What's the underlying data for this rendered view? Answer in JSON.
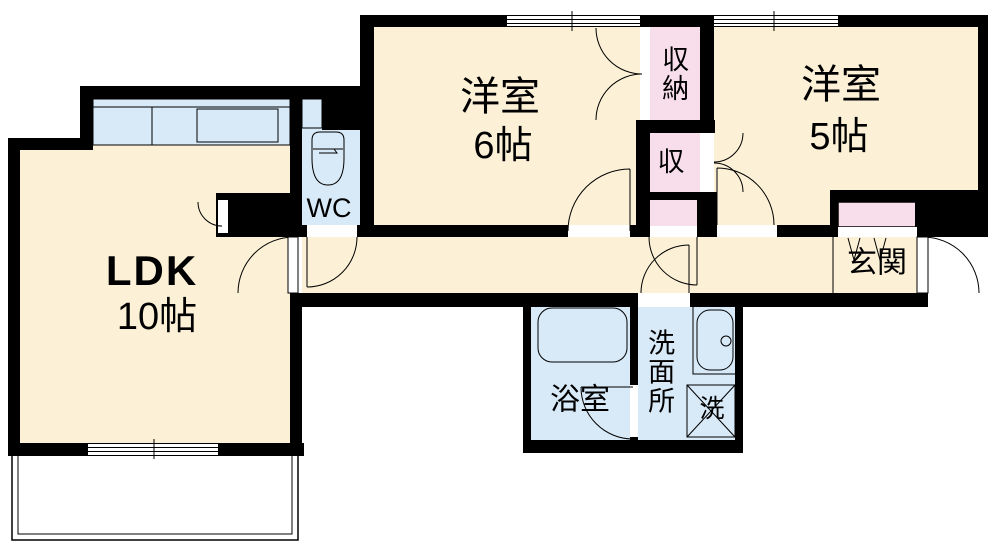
{
  "title": "2LDK apartment floor plan",
  "rooms": {
    "ldk": {
      "label": "LDK",
      "size": "10帖"
    },
    "western6": {
      "label": "洋室",
      "size": "6帖"
    },
    "western5": {
      "label": "洋室",
      "size": "5帖"
    },
    "storage": {
      "label": "収納"
    },
    "storage_small": {
      "label": "収"
    },
    "wc": {
      "label": "WC"
    },
    "entrance": {
      "label": "玄関"
    },
    "bathroom": {
      "label": "浴室"
    },
    "washroom": {
      "label": "洗面所"
    },
    "laundry": {
      "label": "洗"
    }
  },
  "colors": {
    "room_cream": "#FCF1D7",
    "water_blue": "#D8E9F7",
    "storage_pink": "#F8DEEA",
    "wall_black": "#000000"
  }
}
